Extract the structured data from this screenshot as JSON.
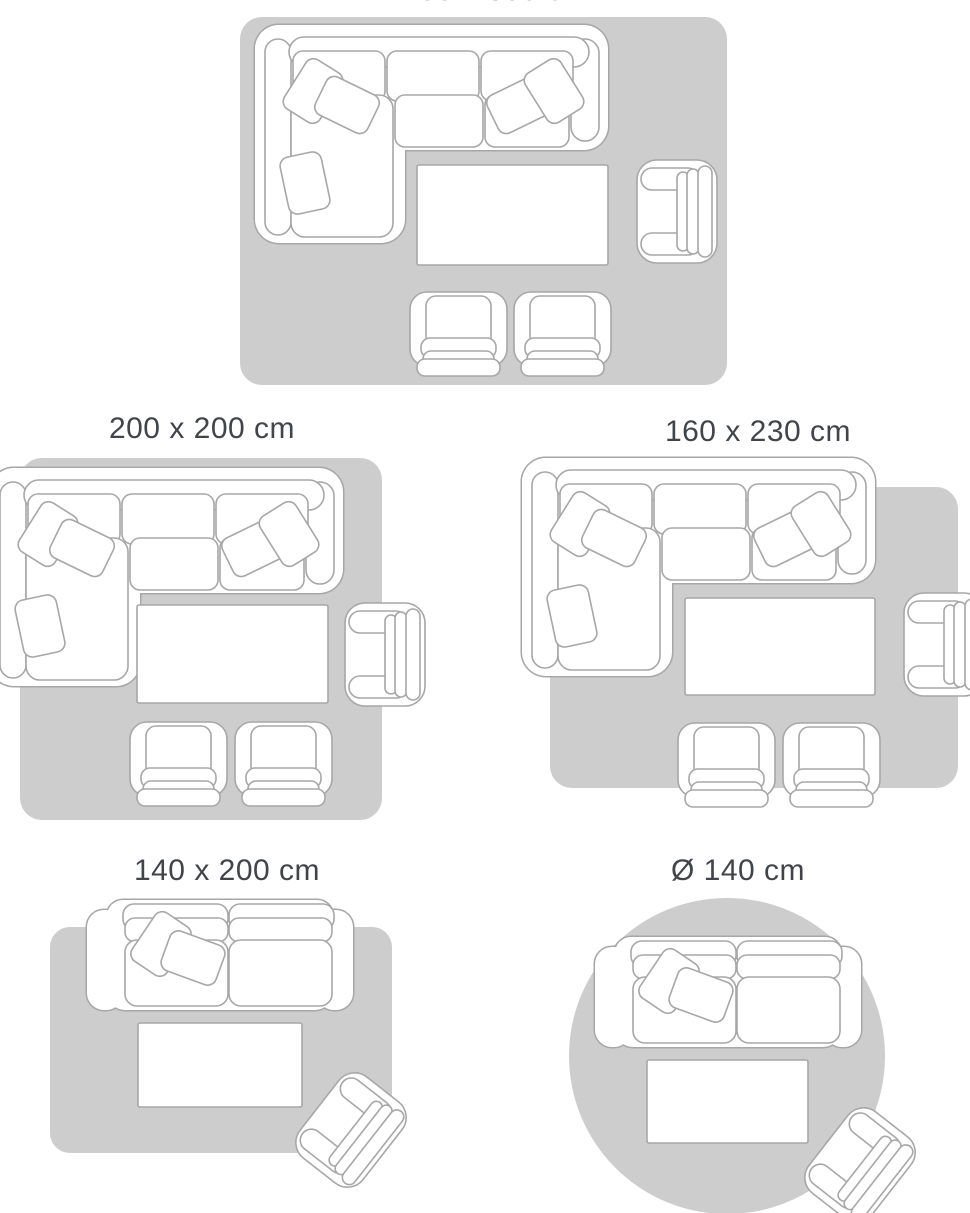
{
  "colors": {
    "page_background": "#ffffff",
    "rug_fill": "#cdcdcd",
    "furniture_fill": "#ffffff",
    "furniture_outline": "#a7a7a7",
    "label_text": "#41454a"
  },
  "size_guide": {
    "layouts": [
      {
        "label": "200 x 300 cm",
        "rug_shape": "rectangle",
        "furniture": [
          "corner-sectional-sofa",
          "cushions",
          "coffee-table",
          "side-armchair",
          "front-armchair",
          "front-armchair"
        ]
      },
      {
        "label": "200 x 200 cm",
        "rug_shape": "square",
        "furniture": [
          "corner-sectional-sofa",
          "cushions",
          "coffee-table",
          "side-armchair",
          "front-armchair",
          "front-armchair"
        ]
      },
      {
        "label": "160 x 230 cm",
        "rug_shape": "rectangle",
        "furniture": [
          "corner-sectional-sofa",
          "cushions",
          "coffee-table",
          "side-armchair",
          "front-armchair",
          "front-armchair"
        ]
      },
      {
        "label": "140 x 200 cm",
        "rug_shape": "rectangle",
        "furniture": [
          "two-seat-sofa",
          "cushions",
          "coffee-table",
          "tilted-armchair"
        ]
      },
      {
        "label": "Ø 140 cm",
        "rug_shape": "circle",
        "furniture": [
          "two-seat-sofa",
          "cushions",
          "coffee-table",
          "tilted-armchair"
        ]
      }
    ]
  }
}
